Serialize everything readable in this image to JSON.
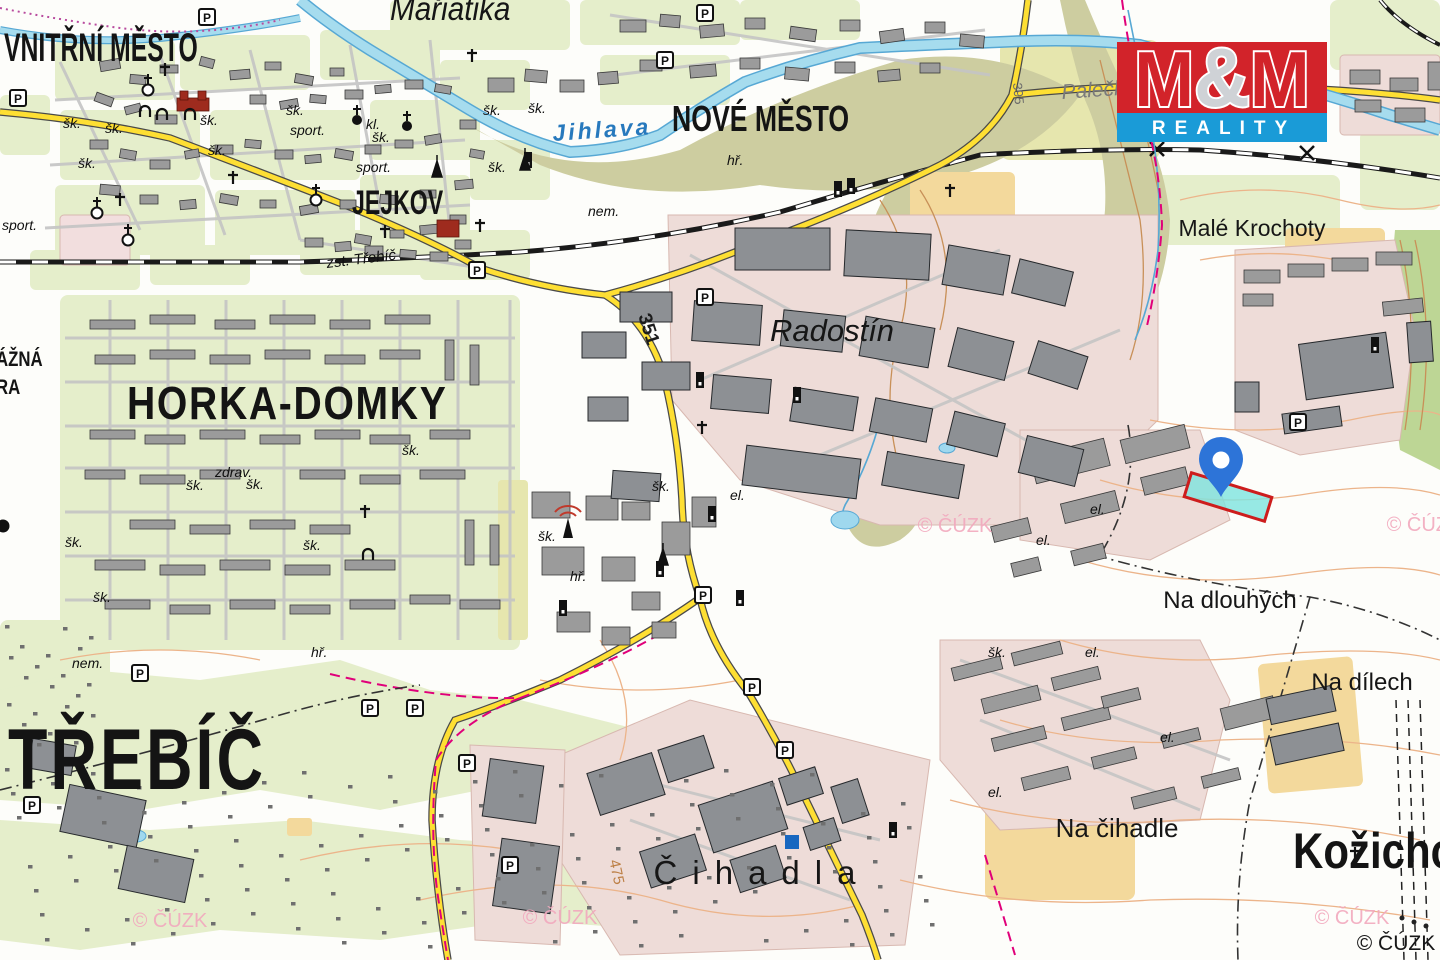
{
  "logo": {
    "m1": "M",
    "amp": "&",
    "m2": "M",
    "subtitle": "REALITY",
    "red": "#d2232a",
    "blue": "#1a9bd7"
  },
  "attribution": {
    "text": "© ČÚZK",
    "x": 1396,
    "y": 950
  },
  "watermark_text": "© ČÚZK",
  "watermark_positions": [
    [
      170,
      927
    ],
    [
      560,
      924
    ],
    [
      955,
      532
    ],
    [
      1424,
      531
    ],
    [
      1352,
      924
    ]
  ],
  "marker": {
    "name": "location-pin",
    "x": 1221,
    "y": 497,
    "color": "#2d74d8",
    "hole": "#ffffff"
  },
  "parcel": {
    "x": 1228,
    "y": 497,
    "width": 84,
    "height": 25,
    "rotation": 17,
    "fill": "#7de4de",
    "stroke": "#cd1d1d"
  },
  "labels": [
    {
      "t": "VNITŘNÍ MĚSTO",
      "x": 4,
      "y": 61,
      "s": 40,
      "c": "lbl-district",
      "sx": 0.62
    },
    {
      "t": "NOVÉ MĚSTO",
      "x": 672,
      "y": 131,
      "s": 36,
      "c": "lbl-district",
      "sx": 0.74
    },
    {
      "t": "JEJKOV",
      "x": 352,
      "y": 214,
      "s": 34,
      "c": "lbl-district",
      "sx": 0.68
    },
    {
      "t": "HORKA-DOMKY",
      "x": 127,
      "y": 419,
      "s": 46,
      "c": "lbl-district",
      "sx": 0.85,
      "ls": 2
    },
    {
      "t": "TŘEBÍČ",
      "x": 8,
      "y": 789,
      "s": 86,
      "c": "lbl-district",
      "sx": 0.75,
      "ls": 4
    },
    {
      "t": "Kožichovice",
      "x": 1293,
      "y": 868,
      "s": 50,
      "c": "lbl-district",
      "sx": 0.84
    },
    {
      "t": "ÁŽNÁ",
      "x": -4,
      "y": 366,
      "s": 21,
      "c": "lbl-district",
      "sx": 0.8
    },
    {
      "t": "RA",
      "x": -4,
      "y": 394,
      "s": 21,
      "c": "lbl-district",
      "sx": 0.8
    },
    {
      "t": "Mařiatika",
      "x": 390,
      "y": 20,
      "s": 33,
      "c": "lbl-place-i",
      "sx": 0.9
    },
    {
      "t": "Radostín",
      "x": 832,
      "y": 341,
      "s": 31,
      "c": "lbl-place-i",
      "a": "middle"
    },
    {
      "t": "Malé Krochoty",
      "x": 1252,
      "y": 236,
      "s": 23,
      "a": "middle"
    },
    {
      "t": "Na dlouhých",
      "x": 1230,
      "y": 608,
      "s": 24,
      "a": "middle"
    },
    {
      "t": "Na dílech",
      "x": 1362,
      "y": 690,
      "s": 24,
      "a": "middle"
    },
    {
      "t": "Na čihadle",
      "x": 1117,
      "y": 837,
      "s": 26,
      "a": "middle"
    },
    {
      "t": "Čihadla",
      "x": 762,
      "y": 884,
      "s": 33,
      "a": "middle",
      "ls": 15
    },
    {
      "t": "Palečkův",
      "x": 1062,
      "y": 99,
      "s": 21,
      "c": "lbl-grey",
      "r": -4
    },
    {
      "t": "Jihlava",
      "x": 553,
      "y": 141,
      "s": 23,
      "c": "lbl-river",
      "r": -4,
      "ls": 3
    },
    {
      "t": "zst. Třebíč",
      "x": 327,
      "y": 268,
      "s": 15,
      "c": "lbl-small",
      "r": -7
    },
    {
      "t": "351",
      "x": 643,
      "y": 331,
      "s": 19,
      "c": "lbl-roadnum",
      "r": 72,
      "a": "middle"
    },
    {
      "t": "395",
      "x": 1014,
      "y": 94,
      "s": 13,
      "c": "lbl-roadnum-grey",
      "r": 84,
      "a": "middle"
    },
    {
      "t": "475",
      "x": 612,
      "y": 873,
      "s": 15,
      "c": "lbl-contour",
      "r": 78,
      "a": "middle"
    },
    {
      "t": "šk.",
      "x": 63,
      "y": 128,
      "s": 14,
      "c": "lbl-small"
    },
    {
      "t": "šk.",
      "x": 105,
      "y": 133,
      "s": 14,
      "c": "lbl-small"
    },
    {
      "t": "šk.",
      "x": 78,
      "y": 168,
      "s": 14,
      "c": "lbl-small"
    },
    {
      "t": "šk.",
      "x": 200,
      "y": 125,
      "s": 14,
      "c": "lbl-small"
    },
    {
      "t": "šk.",
      "x": 208,
      "y": 155,
      "s": 14,
      "c": "lbl-small"
    },
    {
      "t": "šk.",
      "x": 286,
      "y": 115,
      "s": 14,
      "c": "lbl-small"
    },
    {
      "t": "šk.",
      "x": 372,
      "y": 142,
      "s": 14,
      "c": "lbl-small"
    },
    {
      "t": "šk.",
      "x": 483,
      "y": 115,
      "s": 14,
      "c": "lbl-small"
    },
    {
      "t": "šk.",
      "x": 528,
      "y": 113,
      "s": 14,
      "c": "lbl-small"
    },
    {
      "t": "šk.",
      "x": 488,
      "y": 172,
      "s": 14,
      "c": "lbl-small"
    },
    {
      "t": "šk.",
      "x": 186,
      "y": 490,
      "s": 14,
      "c": "lbl-small"
    },
    {
      "t": "šk.",
      "x": 246,
      "y": 489,
      "s": 14,
      "c": "lbl-small"
    },
    {
      "t": "šk.",
      "x": 402,
      "y": 455,
      "s": 14,
      "c": "lbl-small"
    },
    {
      "t": "šk.",
      "x": 65,
      "y": 547,
      "s": 14,
      "c": "lbl-small"
    },
    {
      "t": "šk.",
      "x": 303,
      "y": 550,
      "s": 14,
      "c": "lbl-small"
    },
    {
      "t": "šk.",
      "x": 93,
      "y": 602,
      "s": 14,
      "c": "lbl-small"
    },
    {
      "t": "šk.",
      "x": 652,
      "y": 491,
      "s": 14,
      "c": "lbl-small"
    },
    {
      "t": "šk.",
      "x": 538,
      "y": 541,
      "s": 14,
      "c": "lbl-small"
    },
    {
      "t": "šk.",
      "x": 988,
      "y": 657,
      "s": 14,
      "c": "lbl-small"
    },
    {
      "t": "sport.",
      "x": 2,
      "y": 230,
      "s": 14,
      "c": "lbl-small"
    },
    {
      "t": "sport.",
      "x": 290,
      "y": 135,
      "s": 14,
      "c": "lbl-small"
    },
    {
      "t": "sport.",
      "x": 356,
      "y": 172,
      "s": 14,
      "c": "lbl-small"
    },
    {
      "t": "el.",
      "x": 730,
      "y": 500,
      "s": 14,
      "c": "lbl-small"
    },
    {
      "t": "el.",
      "x": 1090,
      "y": 514,
      "s": 14,
      "c": "lbl-small"
    },
    {
      "t": "el.",
      "x": 1036,
      "y": 545,
      "s": 14,
      "c": "lbl-small"
    },
    {
      "t": "el.",
      "x": 1085,
      "y": 657,
      "s": 14,
      "c": "lbl-small"
    },
    {
      "t": "el.",
      "x": 1160,
      "y": 742,
      "s": 14,
      "c": "lbl-small"
    },
    {
      "t": "el.",
      "x": 988,
      "y": 797,
      "s": 14,
      "c": "lbl-small"
    },
    {
      "t": "hř.",
      "x": 727,
      "y": 165,
      "s": 14,
      "c": "lbl-small"
    },
    {
      "t": "hř.",
      "x": 570,
      "y": 581,
      "s": 14,
      "c": "lbl-small"
    },
    {
      "t": "hř.",
      "x": 311,
      "y": 657,
      "s": 14,
      "c": "lbl-small"
    },
    {
      "t": "nem.",
      "x": 588,
      "y": 216,
      "s": 14,
      "c": "lbl-small"
    },
    {
      "t": "nem.",
      "x": 72,
      "y": 668,
      "s": 14,
      "c": "lbl-small"
    },
    {
      "t": "zdrav.",
      "x": 215,
      "y": 477,
      "s": 14,
      "c": "lbl-small"
    },
    {
      "t": "kl.",
      "x": 366,
      "y": 129,
      "s": 14,
      "c": "lbl-small"
    }
  ],
  "symbols": {
    "parking": [
      [
        207,
        17
      ],
      [
        18,
        98
      ],
      [
        705,
        13
      ],
      [
        665,
        60
      ],
      [
        477,
        270
      ],
      [
        705,
        297
      ],
      [
        703,
        595
      ],
      [
        140,
        673
      ],
      [
        370,
        708
      ],
      [
        415,
        708
      ],
      [
        467,
        763
      ],
      [
        32,
        805
      ],
      [
        752,
        687
      ],
      [
        785,
        750
      ],
      [
        510,
        865
      ],
      [
        1298,
        422
      ]
    ],
    "churches": [
      [
        148,
        90
      ],
      [
        128,
        240
      ],
      [
        97,
        213
      ],
      [
        316,
        200
      ]
    ],
    "churches_filled": [
      [
        357,
        120
      ],
      [
        407,
        126
      ]
    ],
    "crosses": [
      [
        165,
        76
      ],
      [
        233,
        184
      ],
      [
        385,
        238
      ],
      [
        472,
        62
      ],
      [
        480,
        232
      ],
      [
        702,
        434
      ],
      [
        950,
        197
      ],
      [
        365,
        518
      ],
      [
        1355,
        860
      ],
      [
        120,
        206
      ]
    ],
    "chapels": [
      [
        145,
        117
      ],
      [
        162,
        120
      ],
      [
        190,
        120
      ],
      [
        368,
        560
      ]
    ],
    "chimneys": [
      [
        838,
        197
      ],
      [
        851,
        194
      ],
      [
        528,
        168
      ],
      [
        700,
        388
      ],
      [
        797,
        403
      ],
      [
        712,
        522
      ],
      [
        740,
        606
      ],
      [
        563,
        616
      ],
      [
        660,
        577
      ],
      [
        893,
        838
      ],
      [
        1375,
        353
      ]
    ],
    "monuments": [
      [
        525,
        170
      ],
      [
        663,
        565
      ],
      [
        437,
        177
      ]
    ],
    "antenna": [
      568,
      538
    ],
    "blue_square": [
      792,
      842
    ],
    "black_dot": [
      3,
      526
    ]
  }
}
